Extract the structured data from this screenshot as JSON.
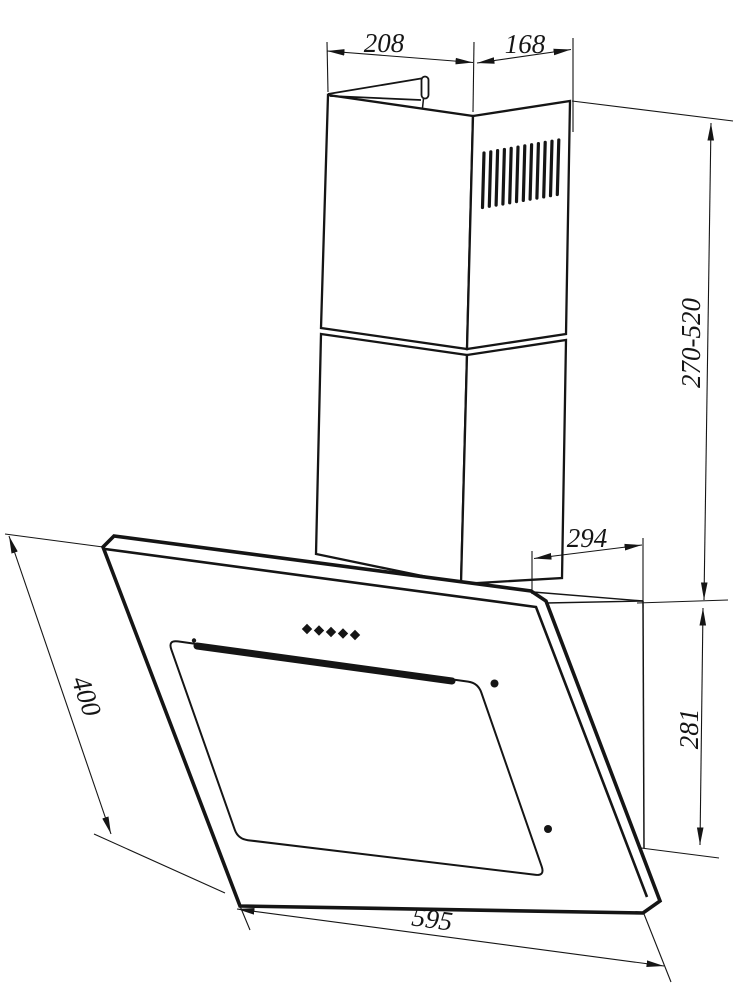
{
  "drawing": {
    "background_color": "#ffffff",
    "line_color": "#151515",
    "dims": {
      "chimney_width": "208",
      "chimney_depth": "168",
      "chimney_height_range": "270-520",
      "hood_top_depth": "294",
      "hood_back_height": "281",
      "glass_length": "400",
      "hood_width": "595"
    }
  }
}
